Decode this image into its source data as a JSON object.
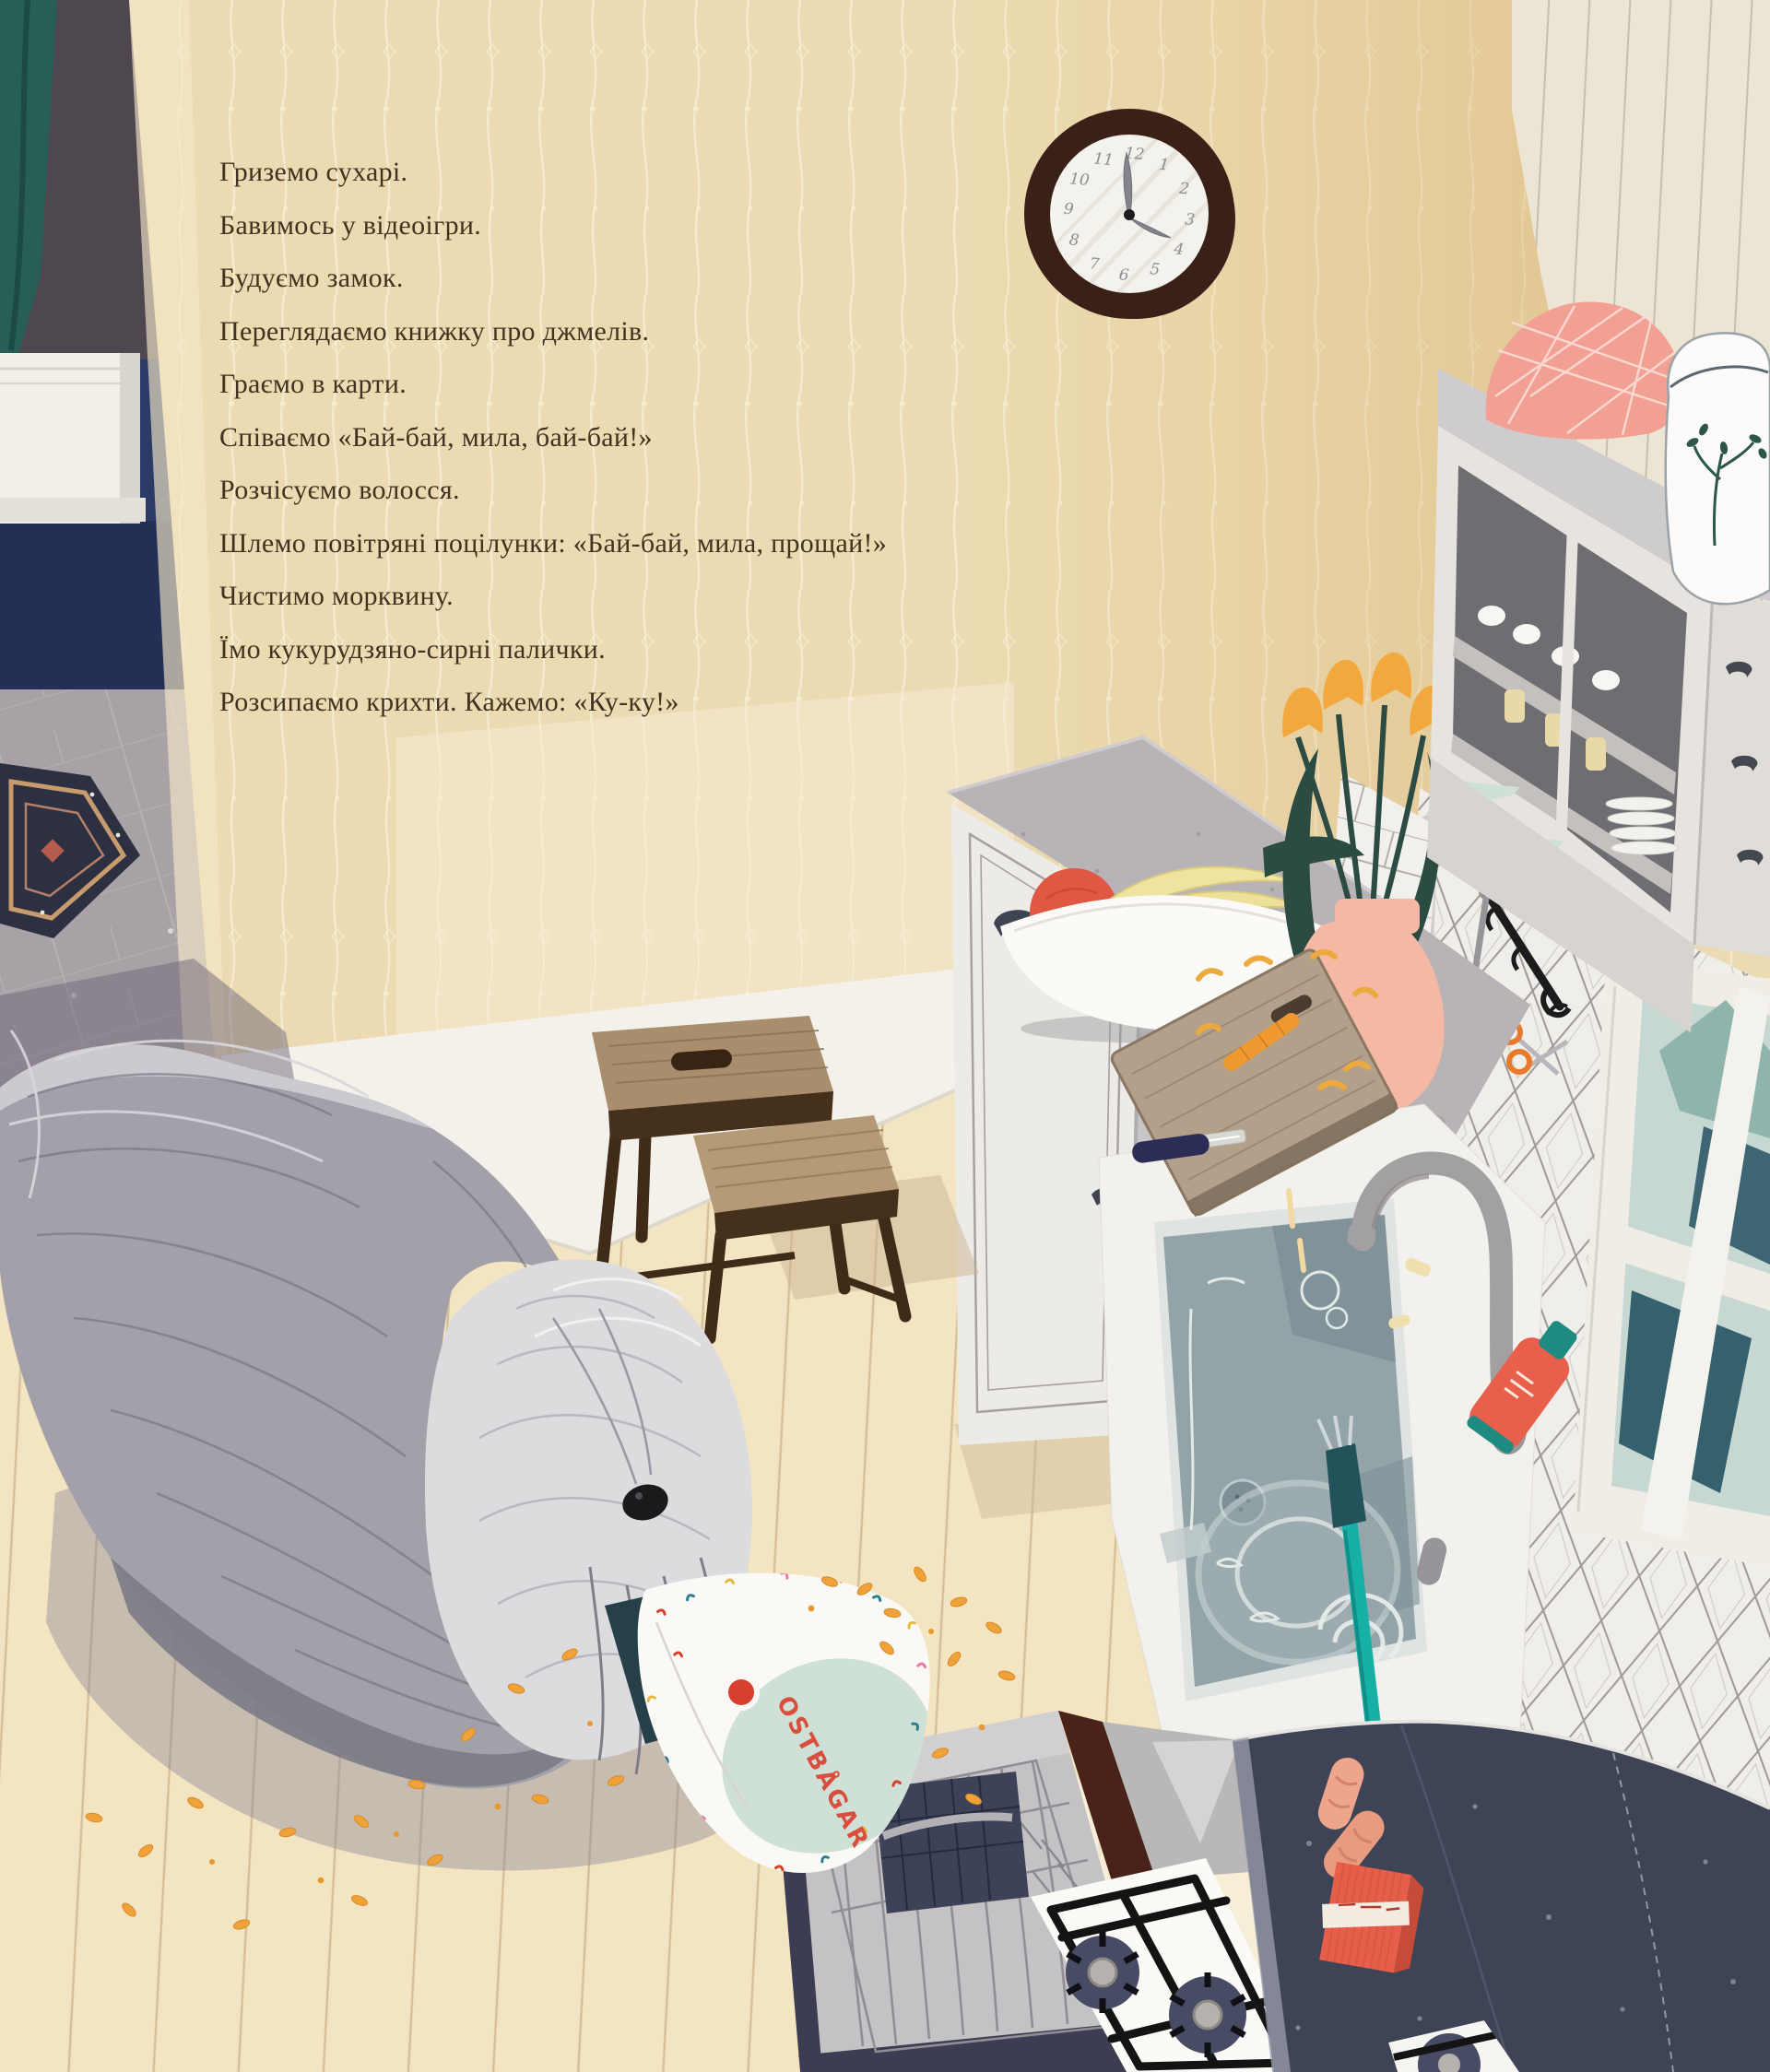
{
  "page": {
    "type": "picture-book-page",
    "scene": "kitchen interior with shaggy grey dog eating cheese puffs from a bag",
    "language": "Ukrainian"
  },
  "story": {
    "lines": [
      "Гриземо сухарі.",
      "Бавимось у відеоігри.",
      "Будуємо замок.",
      "Переглядаємо книжку про джмелів.",
      "Граємо в карти.",
      "Співаємо «Бай-бай, мила, бай-бай!»",
      "Розчісуємо волосся.",
      "Шлемо повітряні поцілунки: «Бай-бай, мила, прощай!»",
      "Чистимо морквину.",
      "Їмо кукурудзяно-сирні палички.",
      "Розсипаємо крихти. Кажемо: «Ку-ку!»"
    ]
  },
  "clock": {
    "time_shown": "4:00",
    "numerals": [
      "12",
      "1",
      "2",
      "3",
      "4",
      "5",
      "6",
      "7",
      "8",
      "9",
      "10",
      "11"
    ]
  },
  "snack_bag": {
    "brand": "OSTBÅGAR"
  },
  "palette": {
    "wall": "#ecdbb2",
    "story_text": "#43321f",
    "bag_brand_red": "#d94f3d",
    "oven_navy": "#3f4356",
    "puffs_orange": "#f0a23a",
    "brush_teal": "#17b0a6",
    "floor_wood": "#f3e5c1",
    "curtain_teal": "#275e56"
  }
}
